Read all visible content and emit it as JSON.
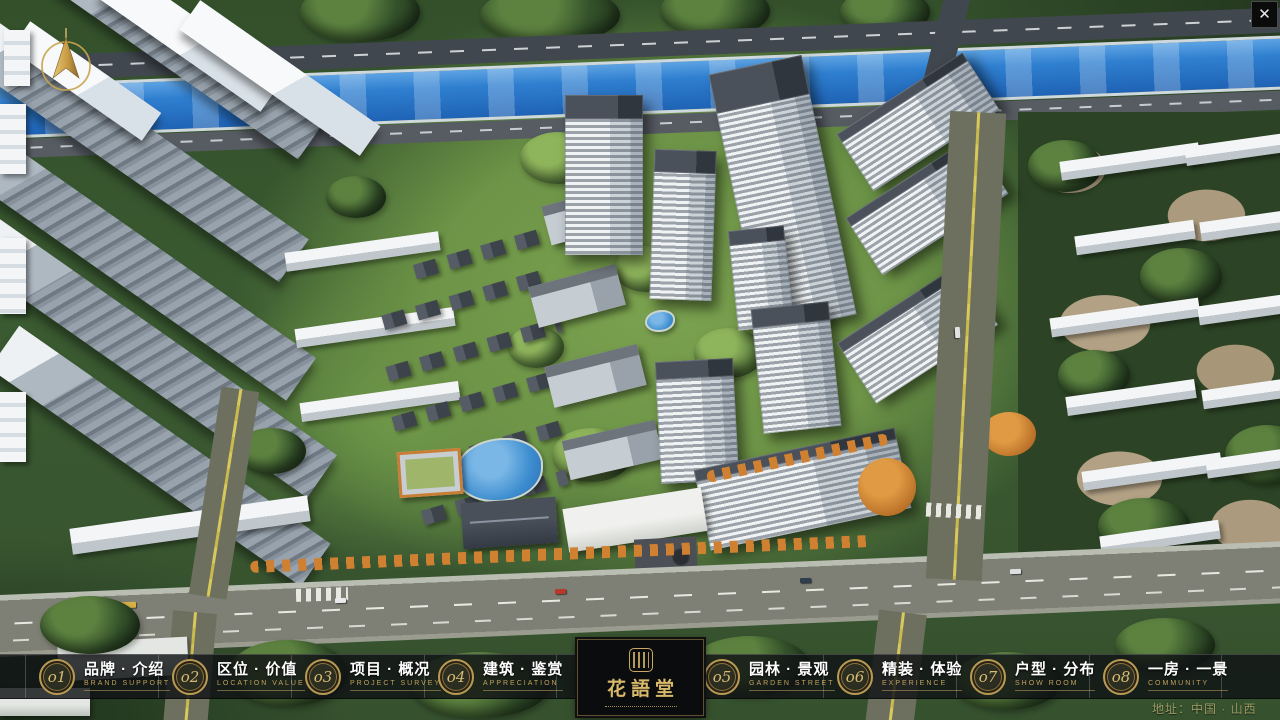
{
  "window": {
    "close_glyph": "✕"
  },
  "navbar": {
    "items": [
      {
        "index": "o1",
        "title_zh": "品牌 · 介绍",
        "title_en": "BRAND SUPPORT"
      },
      {
        "index": "o2",
        "title_zh": "区位 · 价值",
        "title_en": "LOCATION VALUE"
      },
      {
        "index": "o3",
        "title_zh": "项目 · 概况",
        "title_en": "PROJECT SURVEY"
      },
      {
        "index": "o4",
        "title_zh": "建筑 · 鉴赏",
        "title_en": "APPRECIATION"
      },
      {
        "index": "o5",
        "title_zh": "园林 · 景观",
        "title_en": "GARDEN STREET"
      },
      {
        "index": "o6",
        "title_zh": "精装 · 体验",
        "title_en": "EXPERIENCE"
      },
      {
        "index": "o7",
        "title_zh": "户型 · 分布",
        "title_en": "SHOW ROOM"
      },
      {
        "index": "o8",
        "title_zh": "一房 · 一景",
        "title_en": "COMMUNITY"
      }
    ]
  },
  "logo": {
    "title": "花語堂"
  },
  "footer": {
    "address": "地址：中国 · 山西"
  },
  "colors": {
    "gold_accent": "#c9a961",
    "navbar_bg": "rgba(16,18,21,0.82)",
    "logo_bg": "#0a0c0e",
    "river_blue": "#2f7fd0"
  }
}
